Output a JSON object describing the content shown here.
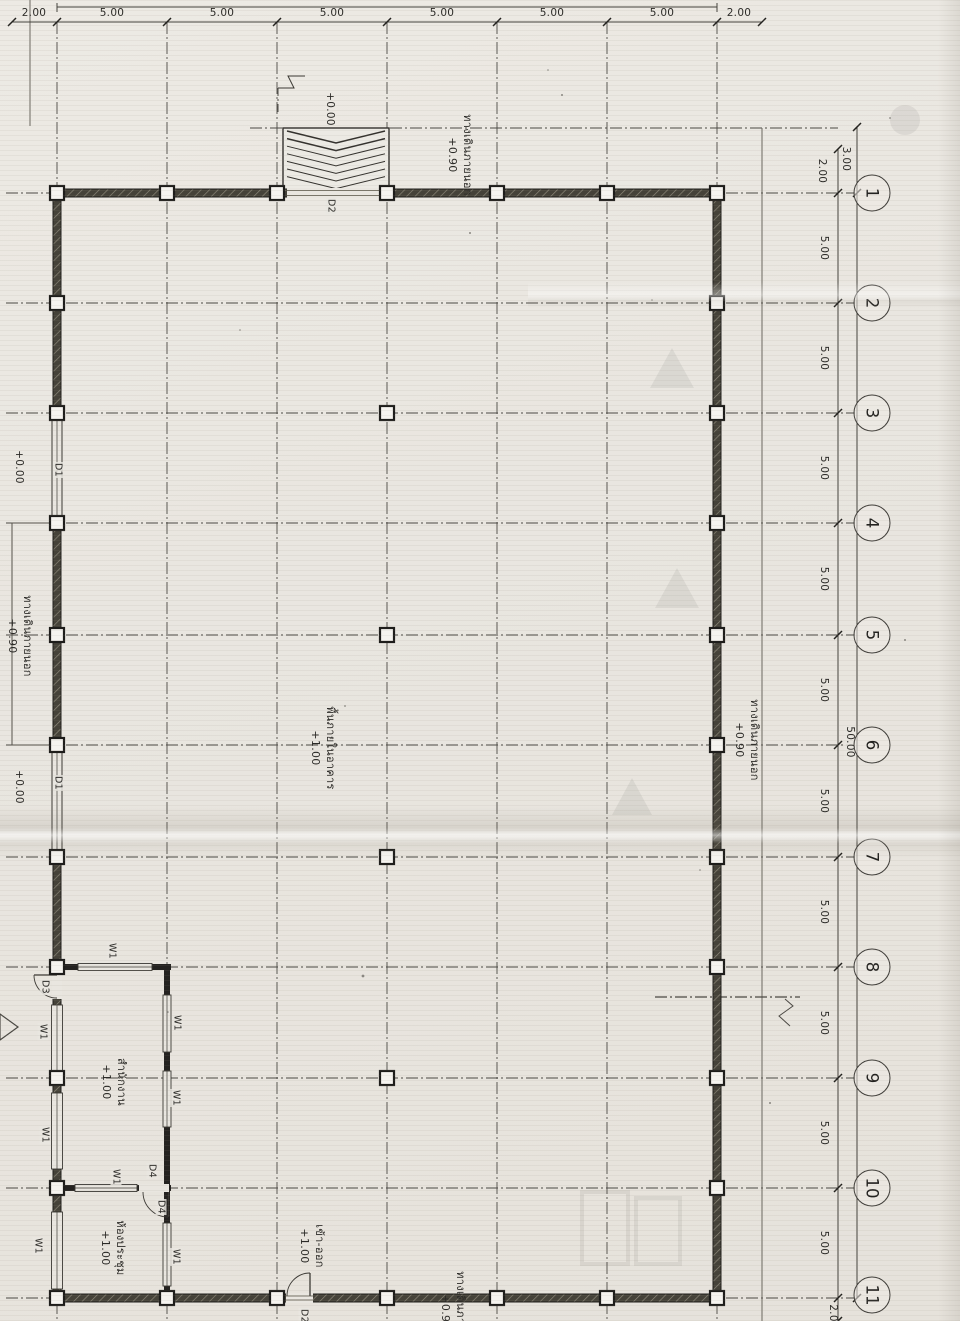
{
  "palette": {
    "paper": "#e9e6e0",
    "ink": "#2b2a27",
    "wall": "#454239",
    "gridline": "#55534e"
  },
  "dims": {
    "top_total": "30.00",
    "top_chain": [
      "2.00",
      "5.00",
      "5.00",
      "5.00",
      "5.00",
      "5.00",
      "5.00",
      "2.00"
    ],
    "right_upper_outer": "3.00",
    "right_upper_inner": "2.00",
    "right_chain": [
      "5.00",
      "5.00",
      "5.00",
      "5.00",
      "5.00",
      "5.00",
      "5.00",
      "5.00",
      "5.00",
      "5.00"
    ],
    "right_total": "50.00",
    "right_below": "2.0"
  },
  "grid_bubbles": [
    "1",
    "2",
    "3",
    "4",
    "5",
    "6",
    "7",
    "8",
    "9",
    "10",
    "11"
  ],
  "areas": {
    "walkway": {
      "name": "ทางเดินภายนอก",
      "level": "+0.90"
    },
    "interior": {
      "name": "พื้นภายในอาคาร",
      "level": "+1.00"
    },
    "office": {
      "name": "สำนักงาน",
      "level": "+1.00"
    },
    "meeting": {
      "name": "ห้องประชุม",
      "level": "+1.00"
    },
    "entry": {
      "name": "เข้า-ออก",
      "level": "+1.00"
    },
    "ground_level": "+0.00"
  },
  "tags": {
    "door1": "D1",
    "door2": "D2",
    "door3": "D3",
    "door4": "D4",
    "window1": "W1"
  }
}
